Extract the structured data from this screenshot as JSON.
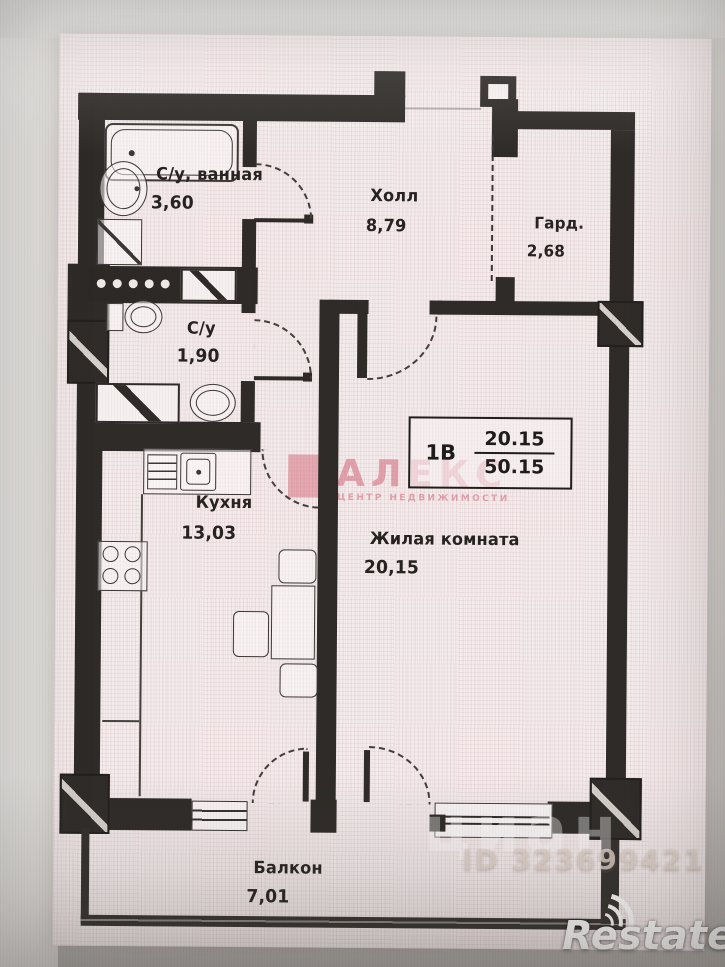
{
  "plan": {
    "unit_box": {
      "unit": "1В",
      "upper_value": "20.15",
      "lower_value": "50.15"
    },
    "rooms": [
      {
        "name": "С/у, ванная",
        "area": "3,60"
      },
      {
        "name": "Холл",
        "area": "8,79"
      },
      {
        "name": "Гард.",
        "area": "2,68"
      },
      {
        "name": "С/у",
        "area": "1,90"
      },
      {
        "name": "Кухня",
        "area": "13,03"
      },
      {
        "name": "Жилая комната",
        "area": "20,15"
      },
      {
        "name": "Балкон",
        "area": "7,01"
      }
    ],
    "fixtures": [
      "bathtub",
      "washbasin",
      "washing-machine",
      "towel-radiator",
      "toilet",
      "pedestal-sink",
      "vent-shaft",
      "kitchen-sink",
      "stove",
      "dining-table",
      "chair",
      "balcony-windows"
    ]
  },
  "watermarks": {
    "agency_name": "АЛЕКС",
    "agency_tagline": "ЦЕНТР НЕДВИЖИМОСТИ",
    "listing_site": "циан",
    "listing_id": "ID 323699421",
    "portal_logo": "Restate"
  },
  "colors": {
    "wall": "#2e2b28",
    "paper": "#f4ecec",
    "agency_pink": "#d36678"
  }
}
